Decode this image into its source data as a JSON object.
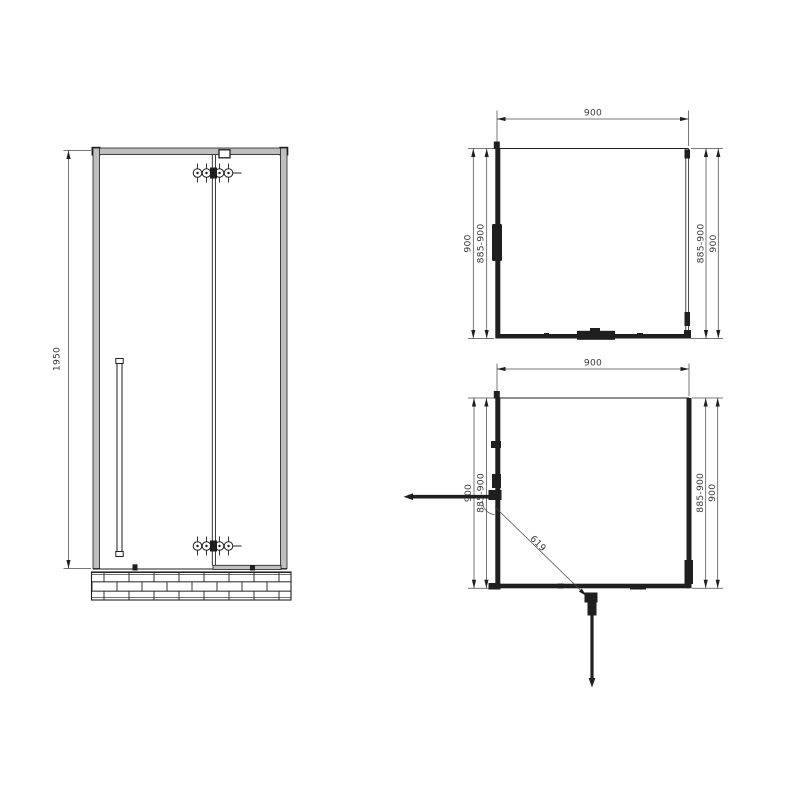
{
  "drawing": {
    "type": "shower-enclosure-technical-drawing",
    "colors": {
      "line": "#1f1f1f",
      "dimension_line": "#4a4a4a",
      "dimension_text": "#3a3a3a",
      "frame_fill": "#bfbfbf",
      "background": "#ffffff"
    },
    "views": {
      "front": {
        "height_label": "1950"
      },
      "plan_closed": {
        "width_label": "900",
        "left_outer_label": "900",
        "left_inner_label": "885-900",
        "right_inner_label": "885-900",
        "right_outer_label": "900"
      },
      "plan_open": {
        "width_label": "900",
        "left_outer_label": "900",
        "left_inner_label": "885-900",
        "right_inner_label": "885-900",
        "right_outer_label": "900",
        "diagonal_label": "619"
      }
    }
  }
}
